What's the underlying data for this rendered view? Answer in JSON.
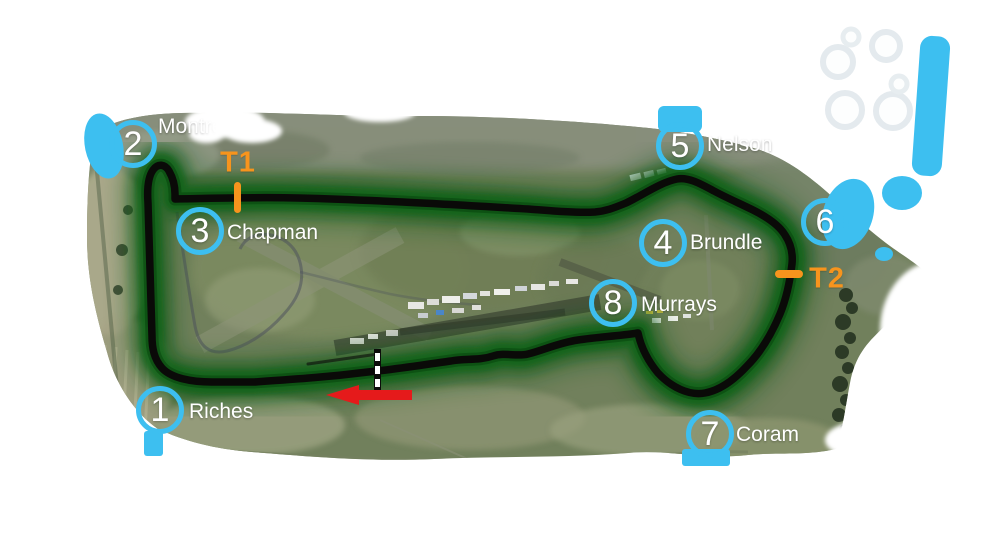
{
  "track_map": {
    "corners": [
      {
        "number": "1",
        "name": "Riches",
        "x": 160,
        "y": 410,
        "label_dx": 29,
        "label_dy": 2
      },
      {
        "number": "2",
        "name": "Montreal",
        "x": 133,
        "y": 144,
        "label_dx": 25,
        "label_dy": -17,
        "fade": true
      },
      {
        "number": "3",
        "name": "Chapman",
        "x": 200,
        "y": 231,
        "label_dx": 27,
        "label_dy": 2
      },
      {
        "number": "4",
        "name": "Brundle",
        "x": 663,
        "y": 243,
        "label_dx": 27,
        "label_dy": 0
      },
      {
        "number": "5",
        "name": "Nelson",
        "x": 680,
        "y": 146,
        "label_dx": 27,
        "label_dy": -1
      },
      {
        "number": "6",
        "name": "",
        "x": 825,
        "y": 222
      },
      {
        "number": "7",
        "name": "Coram",
        "x": 710,
        "y": 434,
        "label_dx": 26,
        "label_dy": 1
      },
      {
        "number": "8",
        "name": "Murrays",
        "x": 613,
        "y": 303,
        "label_dx": 28,
        "label_dy": 2
      }
    ],
    "sector_markers": [
      {
        "label": "T1",
        "x": 238,
        "y": 163
      },
      {
        "label": "T2",
        "x": 827,
        "y": 279
      }
    ],
    "direction_arrow": {
      "points_to": "left"
    },
    "colors": {
      "marker_ring": "#3DBFF0",
      "sector_orange": "#F7941D",
      "arrow_red": "#E51A1B",
      "track_black": "#0a0a08",
      "glow_green": "#0b5a12"
    }
  }
}
